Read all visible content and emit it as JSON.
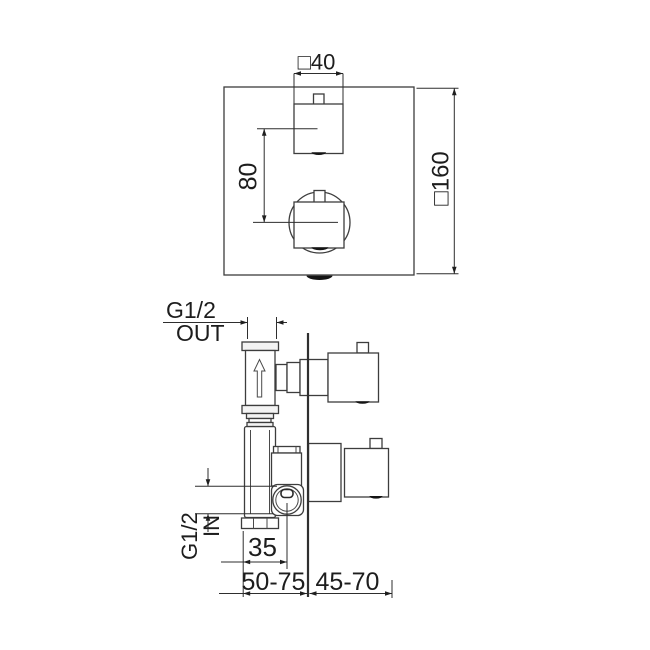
{
  "drawing": {
    "title": "thermostatic-concealed-shower-valve-dimension-drawing",
    "front_view": {
      "handle_width_label": "□40",
      "plate_size_label": "□160",
      "handle_spacing_label": "80"
    },
    "side_view": {
      "outlet_thread_label": "G1/2",
      "outlet_port_label": "OUT",
      "inlet_thread_label": "G1/2",
      "inlet_port_label": "IN",
      "inlet_offset_label": "35",
      "depth_behind_wall_label": "50-75",
      "depth_in_front_wall_label": "45-70"
    },
    "colors": {
      "line": "#3d3d3d",
      "text": "#1d1d1d",
      "dark_mark": "#141414",
      "background": "#ffffff"
    }
  }
}
